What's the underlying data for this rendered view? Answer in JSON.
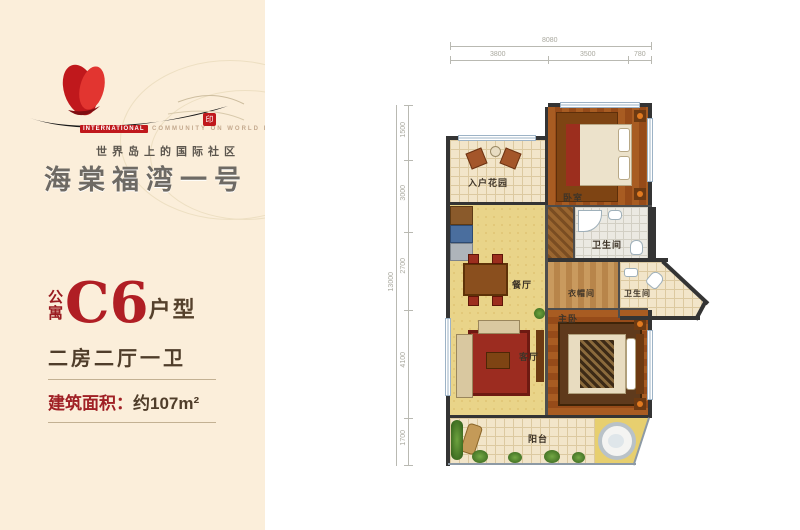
{
  "brand": {
    "english_highlight": "INTERNATIONAL",
    "english_rest": "COMMUNITY ON WORLD ISLAND",
    "seal_glyph": "印",
    "tagline_cn": "世界岛上的国际社区",
    "title_cn": "海棠福湾一号"
  },
  "unit": {
    "prefix_top": "公",
    "prefix_bottom": "寓",
    "code": "C6",
    "suffix": "户型",
    "layout_desc": "二房二厅一卫",
    "area_label": "建筑面积：",
    "area_value": "约107m²"
  },
  "plan": {
    "rooms": [
      {
        "label": "入户花园"
      },
      {
        "label": "卧室"
      },
      {
        "label": "卫生间"
      },
      {
        "label": "餐厅"
      },
      {
        "label": "衣帽间"
      },
      {
        "label": "卫生间"
      },
      {
        "label": "主卧"
      },
      {
        "label": "客厅"
      },
      {
        "label": "阳台"
      }
    ],
    "dims": {
      "top_overall": "8080",
      "top_segments": [
        "3800",
        "3500",
        "780"
      ],
      "left_overall": "13000",
      "left_segments": [
        "1500",
        "3000",
        "2700",
        "4100",
        "1700"
      ]
    }
  },
  "colors": {
    "panel_cream": "#fbeeda",
    "accent_red": "#b01e24",
    "text_brown": "#4f3d2a",
    "wall": "#343434",
    "floor_yellow": "#e9d489",
    "floor_tile": "#f2e5c9",
    "floor_wood": "#a85c22"
  }
}
